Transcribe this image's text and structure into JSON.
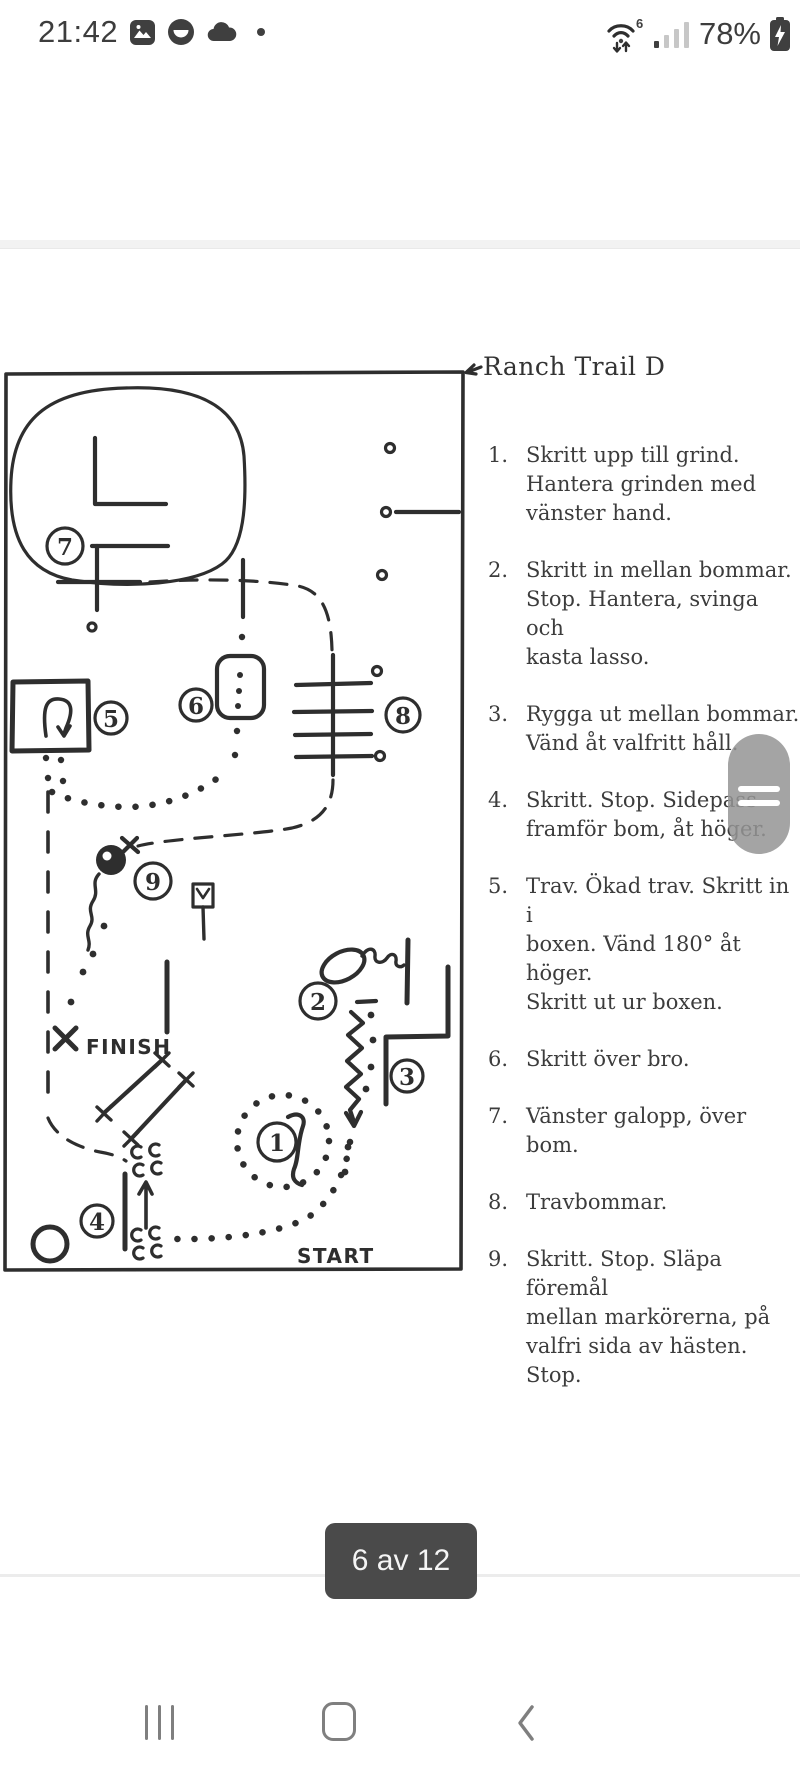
{
  "status_bar": {
    "time": "21:42",
    "battery_percent": "78%",
    "wifi_standard": "6"
  },
  "document": {
    "title": "Ranch Trail D",
    "instructions": [
      {
        "num": "1.",
        "text": "Skritt upp till grind.\nHantera grinden med\nvänster hand."
      },
      {
        "num": "2.",
        "text": "Skritt in mellan bommar.\nStop. Hantera, svinga och\nkasta lasso."
      },
      {
        "num": "3.",
        "text": "Rygga ut mellan bommar.\nVänd åt valfritt håll."
      },
      {
        "num": "4.",
        "text": "Skritt. Stop. Sidepass\nframför bom, åt höger."
      },
      {
        "num": "5.",
        "text": "Trav. Ökad trav. Skritt in i\nboxen. Vänd 180° åt höger.\nSkritt ut ur boxen."
      },
      {
        "num": "6.",
        "text": "Skritt över bro."
      },
      {
        "num": "7.",
        "text": "Vänster galopp, över bom."
      },
      {
        "num": "8.",
        "text": "Travbommar."
      },
      {
        "num": "9.",
        "text": "Skritt. Stop. Släpa föremål\nmellan markörerna, på\nvalfri sida av hästen. Stop."
      }
    ],
    "map_labels": {
      "n1": "1",
      "n2": "2",
      "n3": "3",
      "n4": "4",
      "n5": "5",
      "n6": "6",
      "n7": "7",
      "n8": "8",
      "n9": "9",
      "finish": "FINISH",
      "start": "START"
    }
  },
  "pager": {
    "label": "6 av 12"
  },
  "colors": {
    "ink": "#2e2e2e",
    "chip_bg": "#4a4a4a",
    "scroll_handle": "#949494",
    "nav_icon": "#7f7f7f"
  }
}
